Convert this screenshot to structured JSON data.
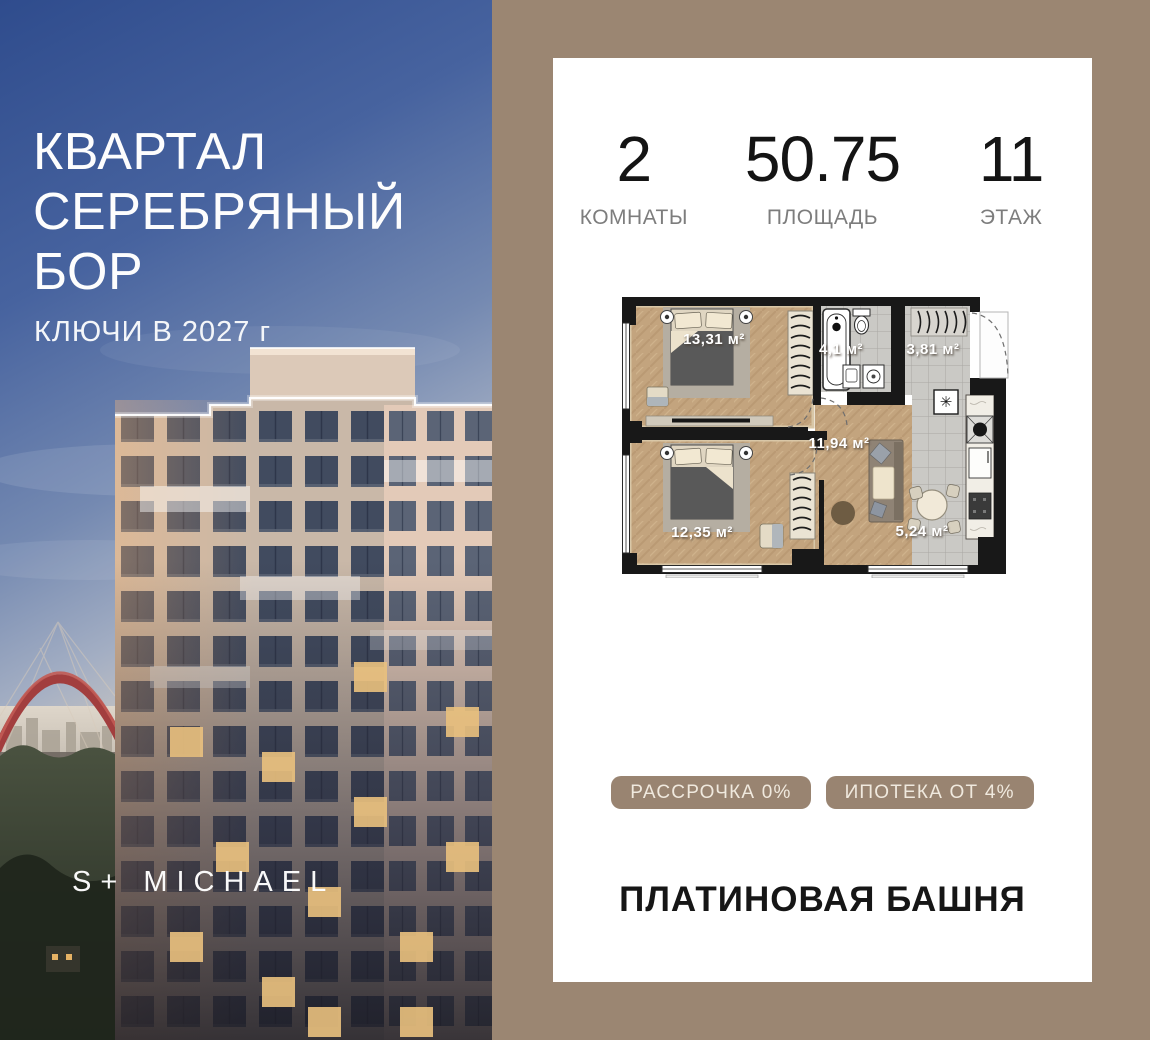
{
  "promo": {
    "title_line1": "КВАРТАЛ",
    "title_line2": "СЕРЕБРЯНЫЙ",
    "title_line3": "БОР",
    "keys_note": "КЛЮЧИ В 2027 г",
    "watermark": "S+ MICHAEL"
  },
  "card": {
    "stats": [
      {
        "value": "2",
        "label": "КОМНАТЫ"
      },
      {
        "value": "50.75",
        "label": "ПЛОЩАДЬ"
      },
      {
        "value": "11",
        "label": "ЭТАЖ"
      }
    ],
    "floorplan": {
      "rooms": [
        {
          "name": "bedroom-1",
          "area_label": "13,31 м²"
        },
        {
          "name": "bathroom",
          "area_label": "4,1 м²"
        },
        {
          "name": "hallway",
          "area_label": "3,81 м²"
        },
        {
          "name": "living-room",
          "area_label": "11,94 м²"
        },
        {
          "name": "bedroom-2",
          "area_label": "12,35 м²"
        },
        {
          "name": "kitchen",
          "area_label": "5,24 м²"
        }
      ]
    },
    "badges": [
      {
        "label": "РАССРОЧКА 0%"
      },
      {
        "label": "ИПОТЕКА ОТ 4%"
      }
    ],
    "building_name": "ПЛАТИНОВАЯ БАШНЯ"
  },
  "colors": {
    "panel_bg": "#9b8672",
    "badge_bg": "#998471",
    "badge_text": "#f0e9de",
    "card_bg": "#ffffff",
    "stat_value": "#141414",
    "stat_label": "#7d7d7d",
    "promo_text": "#ffffff",
    "plan_wall": "#181818",
    "plan_wood": "#c3a47e",
    "plan_tile": "#cac9c5"
  }
}
